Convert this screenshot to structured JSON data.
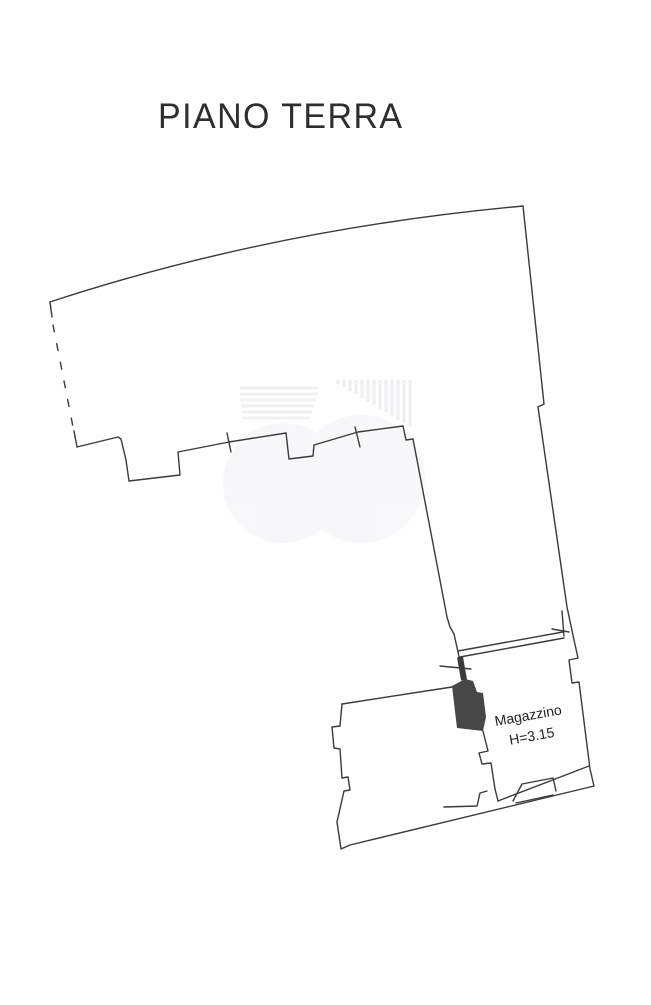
{
  "page": {
    "title": "PIANO TERRA"
  },
  "floorplan": {
    "room": {
      "label": "Magazzino",
      "height_note": "H=3.15"
    },
    "ink_color": "#3a3a3a",
    "watermark_color": "#e7e7eb",
    "paper_color": "#fefefe"
  }
}
